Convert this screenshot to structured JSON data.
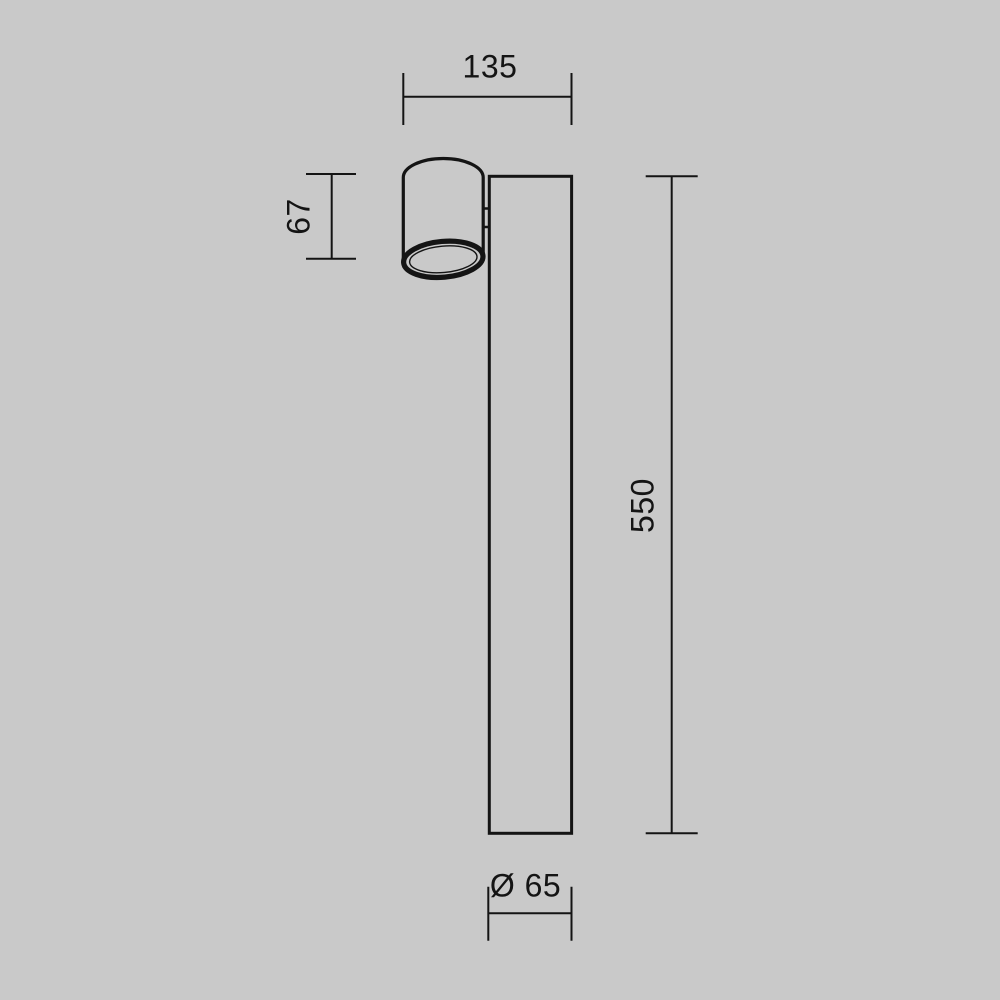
{
  "canvas": {
    "background_color": "#c9c9c9",
    "line_color": "#141414"
  },
  "drawing": {
    "kind": "technical-dimension-drawing",
    "subject": "cylindrical spot lamp head mounted on tall rectangular post",
    "dimensions": {
      "overall_width": {
        "label": "135",
        "position": "top"
      },
      "head_height": {
        "label": "67",
        "position": "left"
      },
      "post_height": {
        "label": "550",
        "position": "right"
      },
      "base_diameter": {
        "label": "Ø 65",
        "position": "bottom"
      }
    }
  }
}
